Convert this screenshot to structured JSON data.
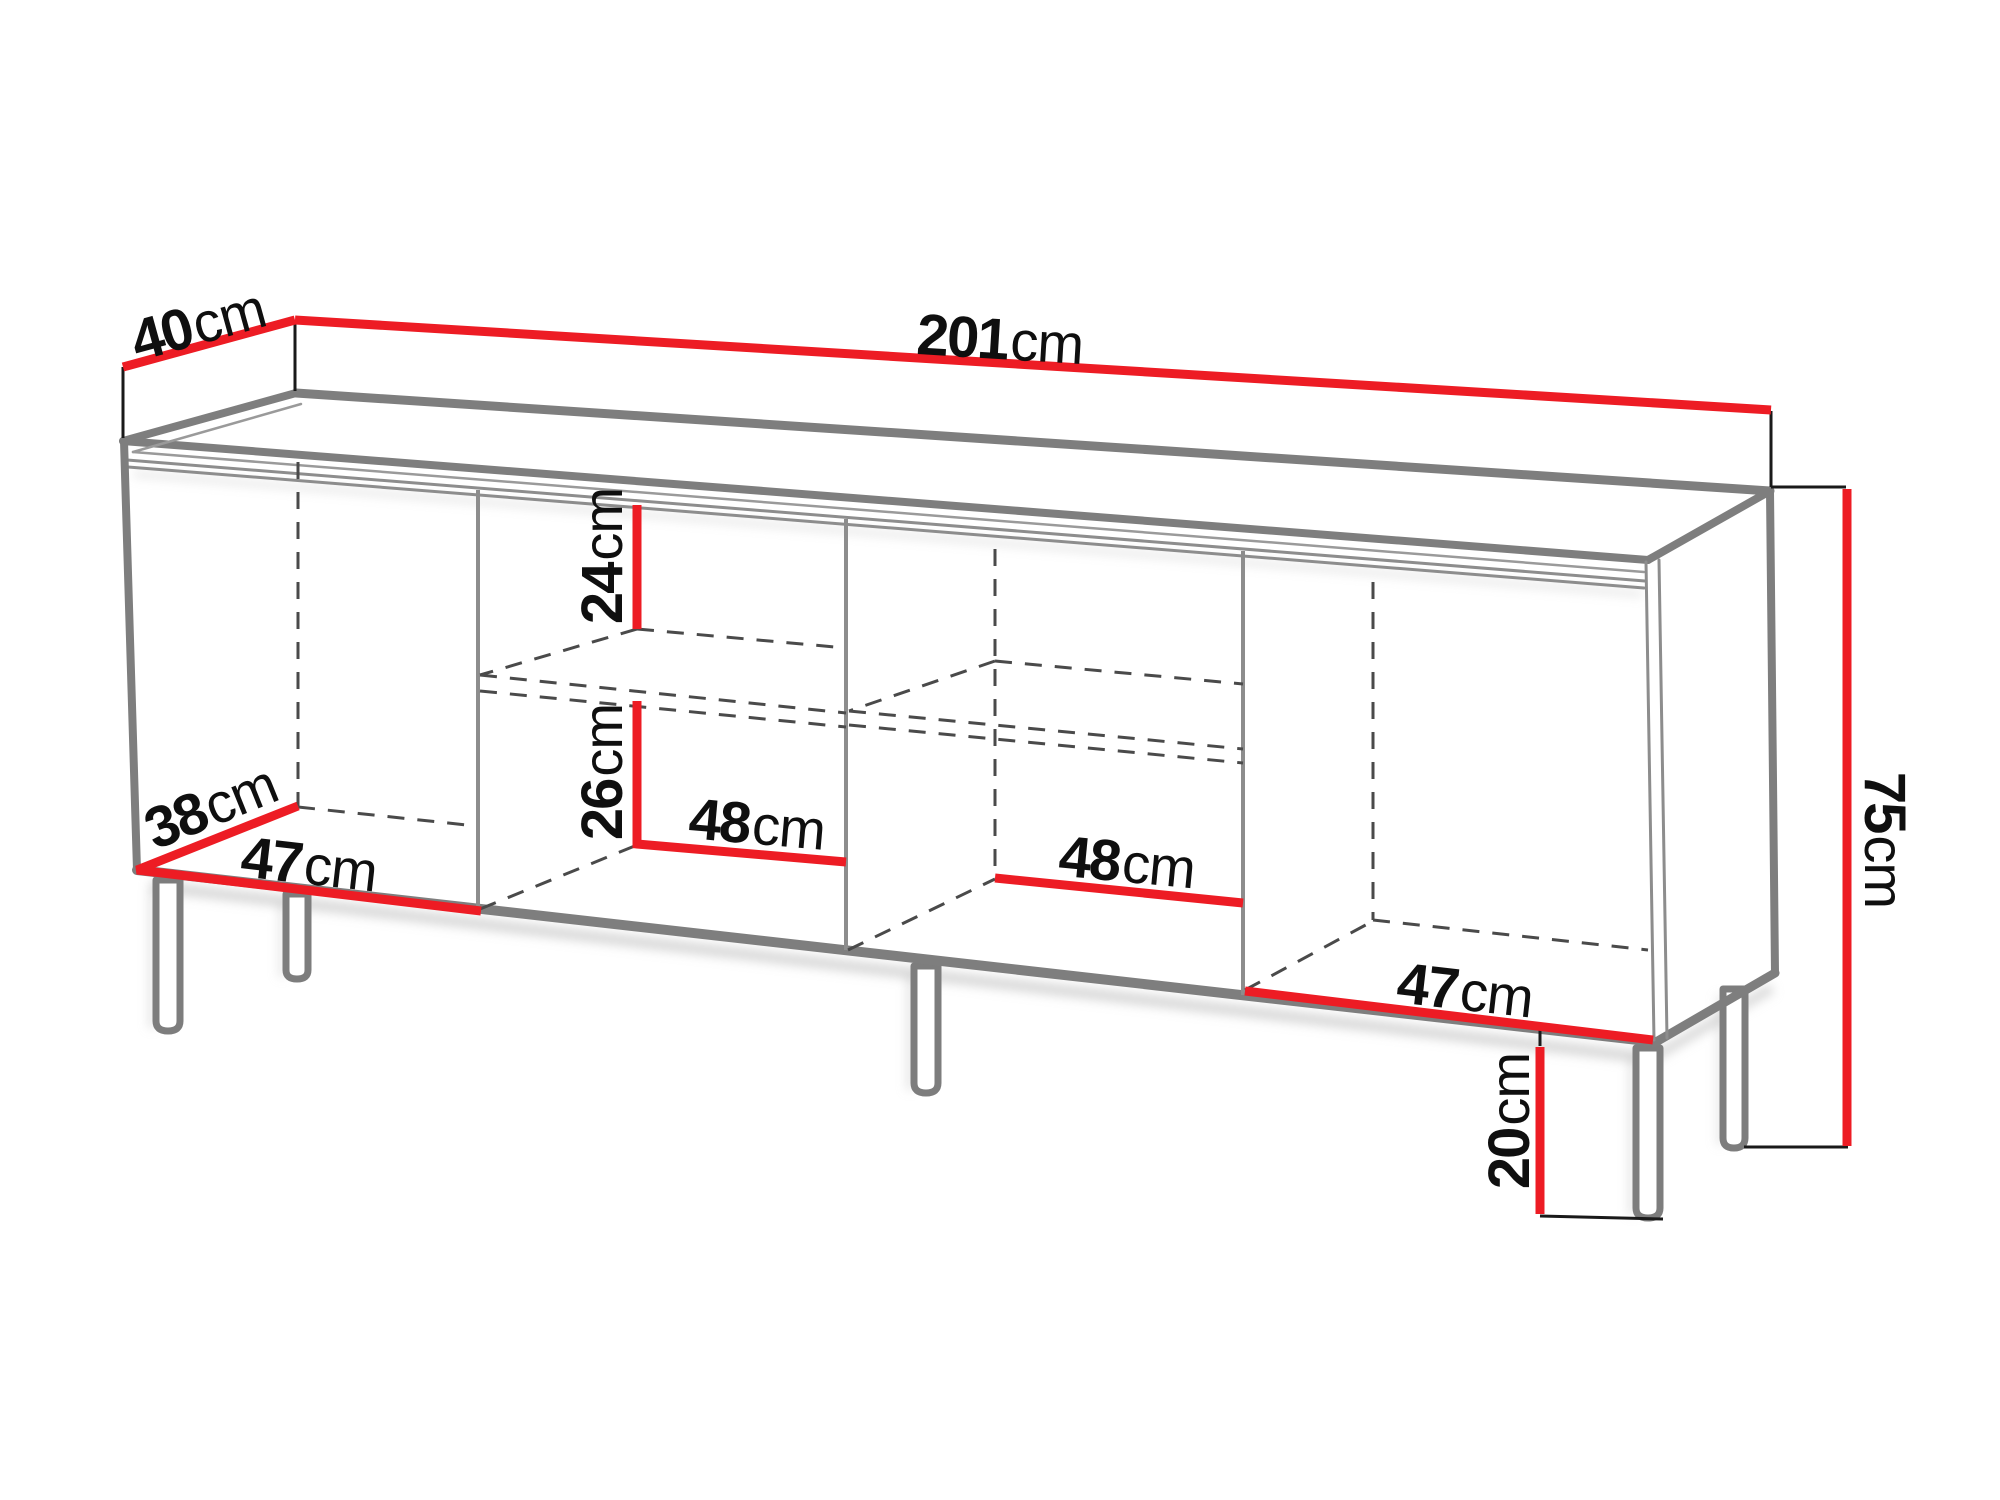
{
  "diagram": {
    "type": "furniture-dimension-diagram",
    "subject": "sideboard-cabinet",
    "unit": "cm",
    "colors": {
      "dimension_line": "#ed1c24",
      "outline_gray": "#7e7e7e",
      "dashed_gray": "#4a4a4a",
      "tick_black": "#1a1a1a",
      "label_text": "#0f0f0f",
      "background": "#ffffff"
    },
    "dimensions": {
      "top_depth": {
        "value": "40",
        "unit": "cm"
      },
      "total_width": {
        "value": "201",
        "unit": "cm"
      },
      "total_height": {
        "value": "75",
        "unit": "cm"
      },
      "upper_shelf_gap": {
        "value": "24",
        "unit": "cm"
      },
      "lower_shelf_gap": {
        "value": "26",
        "unit": "cm"
      },
      "middle_section_width_left": {
        "value": "48",
        "unit": "cm"
      },
      "middle_section_width_right": {
        "value": "48",
        "unit": "cm"
      },
      "interior_depth": {
        "value": "38",
        "unit": "cm"
      },
      "left_section_width": {
        "value": "47",
        "unit": "cm"
      },
      "right_section_width": {
        "value": "47",
        "unit": "cm"
      },
      "leg_height": {
        "value": "20",
        "unit": "cm"
      }
    }
  }
}
